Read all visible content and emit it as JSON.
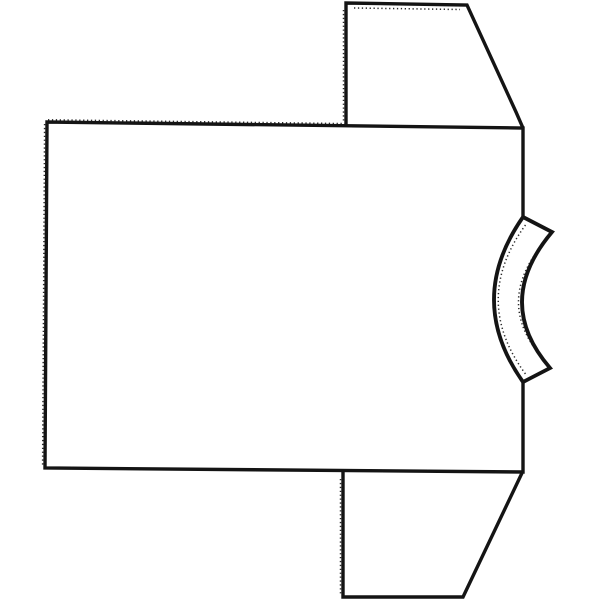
{
  "canvas": {
    "background": "#ffffff",
    "ink": "#141414"
  },
  "figure": {
    "subject": "Black-and-white line drawing of a T-shirt laid sideways with the collar band at the right, sleeves extending above and below; edges have fine pinked (serrated) texture like a sewing-pattern clip art",
    "shapes": {
      "body": {
        "d": "M 523 216 L 523 128 L 47 122 L 45 468 L 523 472 L 523 383"
      },
      "top_sleeve": {
        "d": "M 346 126 L 346 3 L 467 5 L 516 112 L 523 128"
      },
      "bottom_sleeve": {
        "d": "M 343 472 L 343 597 L 463 597 L 522 473"
      },
      "collar_band": {
        "d": "M 523 217 L 552 232 Q 493 302 550 368 L 523 382 Q 465 300 523 217 Z"
      }
    },
    "pinked_edges": {
      "body_top": {
        "d": "M 48 119.8 L 345 123.6"
      },
      "body_left": {
        "d": "M 44.6 124 L 42.6 466"
      },
      "top_sleeve_left": {
        "d": "M 343.5 10 L 343.5 122"
      },
      "top_sleeve_top": {
        "d": "M 354 8 L 460 9.5"
      },
      "bottom_sleeve_left": {
        "d": "M 340.5 479 L 340.5 594"
      },
      "collar_inner": {
        "d": "M 525.5 225 Q 471 300 525.5 374"
      },
      "collar_outer": {
        "d": "M 548 238 Q 490 302 546 362"
      }
    }
  }
}
